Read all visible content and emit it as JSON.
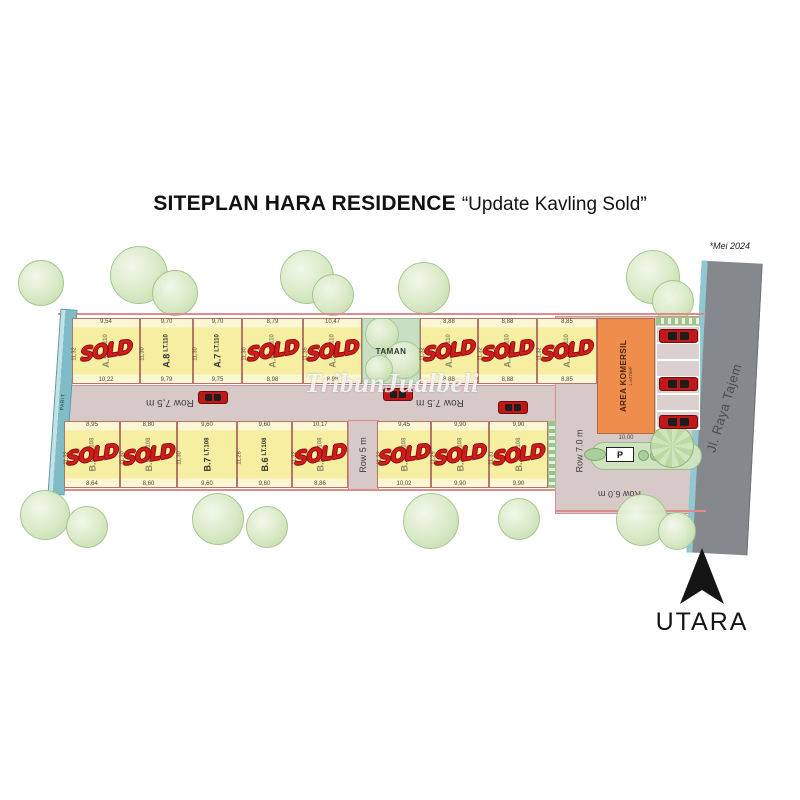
{
  "title": {
    "main": "SITEPLAN HARA RESIDENCE",
    "subtitle": "“Update Kavling Sold”"
  },
  "note": {
    "date": "*Mei 2024"
  },
  "watermark": {
    "text": "TribunJualbeli"
  },
  "compass": {
    "label": "UTARA"
  },
  "labels": {
    "sold": "SOLD"
  },
  "roads": {
    "main_left": "Row 7,5 m",
    "main_right": "Row 7.5 m",
    "row5": "Row 5 m",
    "row7": "Row 7.0 m",
    "row6": "Row 6.0 m",
    "highway": "Jl. Raya Tajem",
    "canal": "PARIT"
  },
  "park": {
    "label": "TAMAN"
  },
  "commercial": {
    "label": "AREA KOMERSIL",
    "area_note": "L.±375M²",
    "front_dim": "10,00",
    "parking_sign": "P"
  },
  "plots_top": [
    {
      "id": "A.9",
      "lt": "LT.110",
      "sold": true,
      "dim_top": "9,54",
      "dim_bottom": "10,22",
      "dim_side": "11,32"
    },
    {
      "id": "A.8",
      "lt": "LT.110",
      "sold": false,
      "dim_top": "9,70",
      "dim_bottom": "9,79",
      "dim_side": "11,30"
    },
    {
      "id": "A.7",
      "lt": "LT.110",
      "sold": false,
      "dim_top": "9,70",
      "dim_bottom": "9,75",
      "dim_side": "11,30"
    },
    {
      "id": "A.6",
      "lt": "LT.110",
      "sold": true,
      "dim_top": "8,79",
      "dim_bottom": "8,98",
      "dim_side": "11,30"
    },
    {
      "id": "A.5",
      "lt": "LT.110",
      "sold": true,
      "dim_top": "10,47",
      "dim_bottom": "8,98",
      "dim_side": "11,35"
    },
    {
      "id": "A.3",
      "lt": "LT.110",
      "sold": true,
      "dim_top": "8,88",
      "dim_bottom": "8,88",
      "dim_side": "11,32"
    },
    {
      "id": "A.2",
      "lt": "LT.110",
      "sold": true,
      "dim_top": "8,88",
      "dim_bottom": "8,88",
      "dim_side": "11,32"
    },
    {
      "id": "A.1",
      "lt": "LT.110",
      "sold": true,
      "dim_top": "8,85",
      "dim_bottom": "8,85",
      "dim_side": "11,32"
    }
  ],
  "plots_bottom": [
    {
      "id": "B.9",
      "lt": "LT.108",
      "sold": true,
      "dim_top": "8,95",
      "dim_bottom": "8,64",
      "dim_side": "11,32"
    },
    {
      "id": "B.8",
      "lt": "LT.108",
      "sold": true,
      "dim_top": "8,80",
      "dim_bottom": "8,60",
      "dim_side": "11,30"
    },
    {
      "id": "B.7",
      "lt": "LT.108",
      "sold": false,
      "dim_top": "9,60",
      "dim_bottom": "9,60",
      "dim_side": "11,30"
    },
    {
      "id": "B.6",
      "lt": "LT.108",
      "sold": false,
      "dim_top": "9,60",
      "dim_bottom": "9,60",
      "dim_side": "11,28"
    },
    {
      "id": "B.5",
      "lt": "LT.108",
      "sold": true,
      "dim_top": "10,17",
      "dim_bottom": "8,86",
      "dim_side": "11,32"
    },
    {
      "id": "B.3",
      "lt": "LT.108",
      "sold": true,
      "dim_top": "9,45",
      "dim_bottom": "10,02",
      "dim_side": "11,32"
    },
    {
      "id": "B.2",
      "lt": "LT.108",
      "sold": true,
      "dim_top": "9,90",
      "dim_bottom": "9,90",
      "dim_side": "11,29"
    },
    {
      "id": "B.1",
      "lt": "LT.108",
      "sold": true,
      "dim_top": "9,90",
      "dim_bottom": "9,90",
      "dim_side": "11,31"
    }
  ]
}
